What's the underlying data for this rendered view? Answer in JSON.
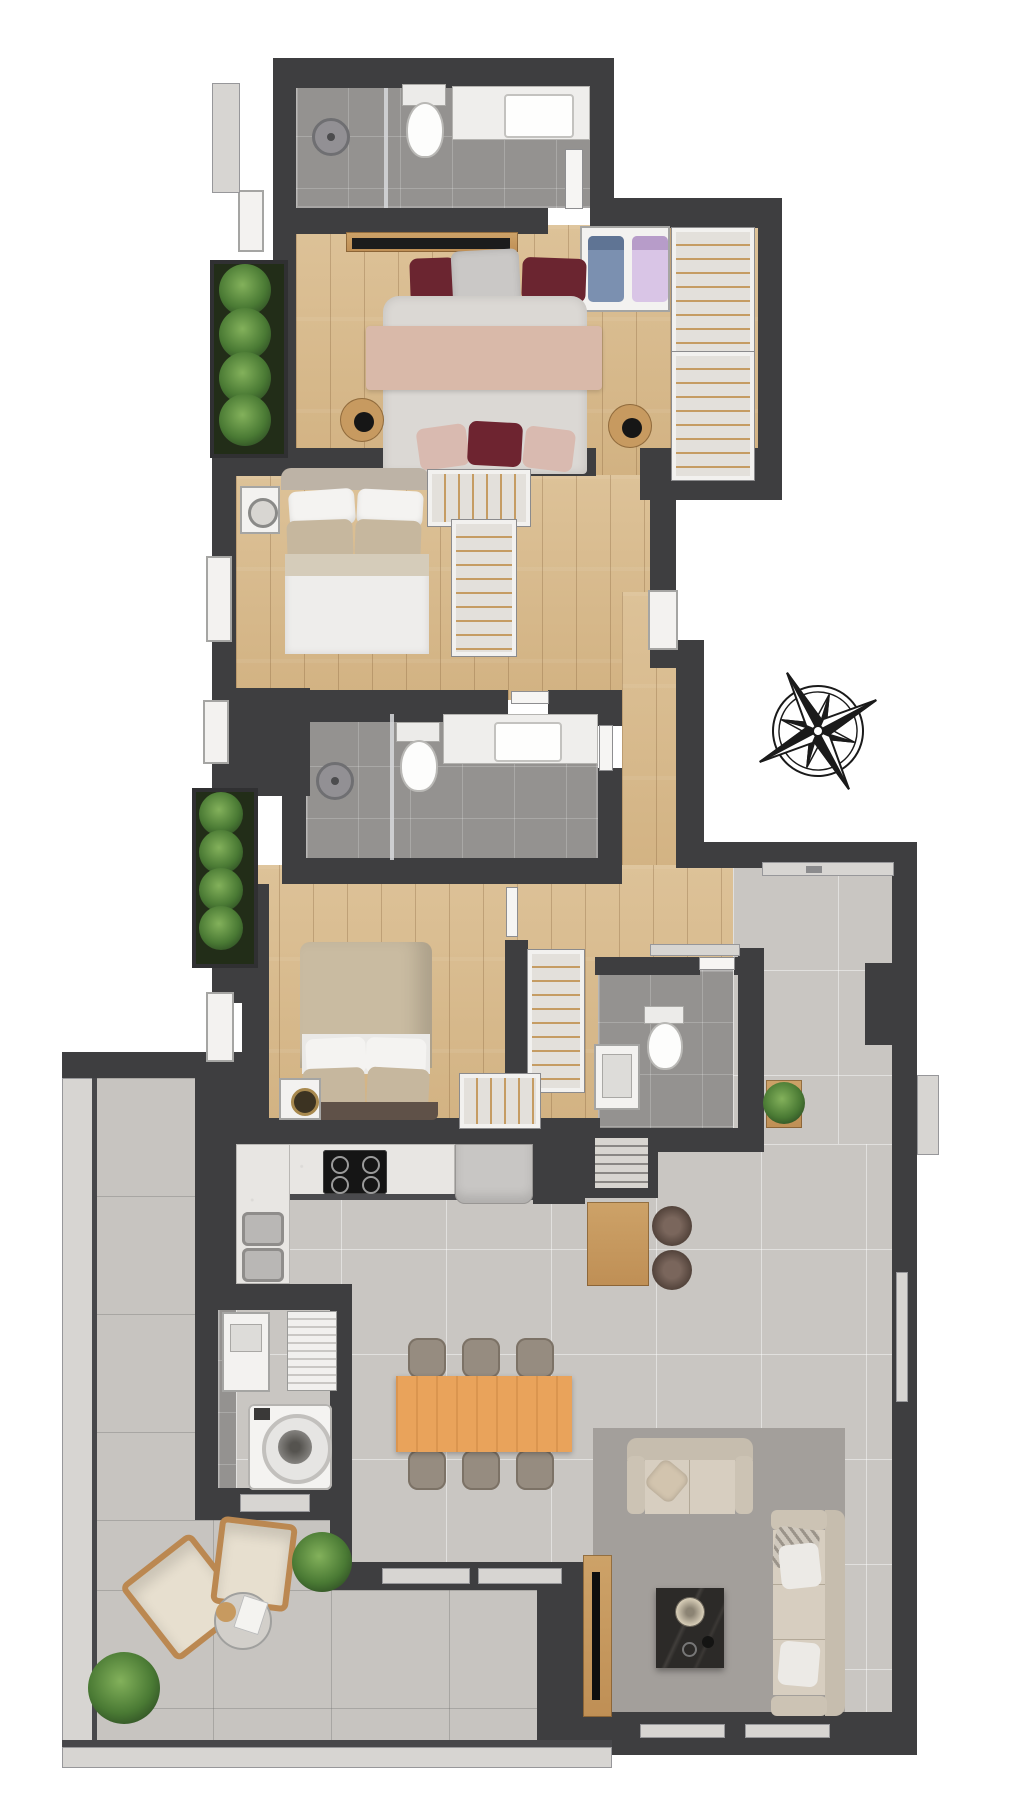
{
  "plan": {
    "title": "Apartment floor plan",
    "rooms": [
      {
        "id": "banho-1",
        "name": "Banho",
        "area": "A:3,91m²"
      },
      {
        "id": "suite",
        "name": "Suíte",
        "area": "A=13,85m²"
      },
      {
        "id": "dormitorio-1",
        "name": "Dormitório",
        "area": "A=9,25m²"
      },
      {
        "id": "banho-2",
        "name": "Banho",
        "area": "A:3,93m²"
      },
      {
        "id": "dormitorio-2",
        "name": "Dormitório",
        "area": "A=9,12m²"
      },
      {
        "id": "circulacao",
        "name": "Circulação",
        "area": "A:4,28m²"
      },
      {
        "id": "lavabo",
        "name": "Lavabo",
        "area": "A:2,20m²"
      },
      {
        "id": "a-servico",
        "name": "Á. Serviço",
        "area": "A:2,94m²"
      },
      {
        "id": "living-cozinha",
        "name": "Living / Cozinha",
        "area": "A:35,05m²"
      },
      {
        "id": "terraco",
        "name": "Terraço",
        "area": "A:15,81m²"
      }
    ],
    "compass": {
      "north": "N",
      "south": "S",
      "east": "E",
      "west": "W"
    },
    "palette": {
      "wall": "#3e3e40",
      "wood_floor": "#d8bc92",
      "bath_tile": "#949290",
      "living_tile": "#c9c6c2",
      "terrace_tile": "#c7c4c0",
      "table_wood": "#e9a35b",
      "plant_green": "#4a7a34",
      "maroon_cushion": "#6b2530"
    }
  }
}
